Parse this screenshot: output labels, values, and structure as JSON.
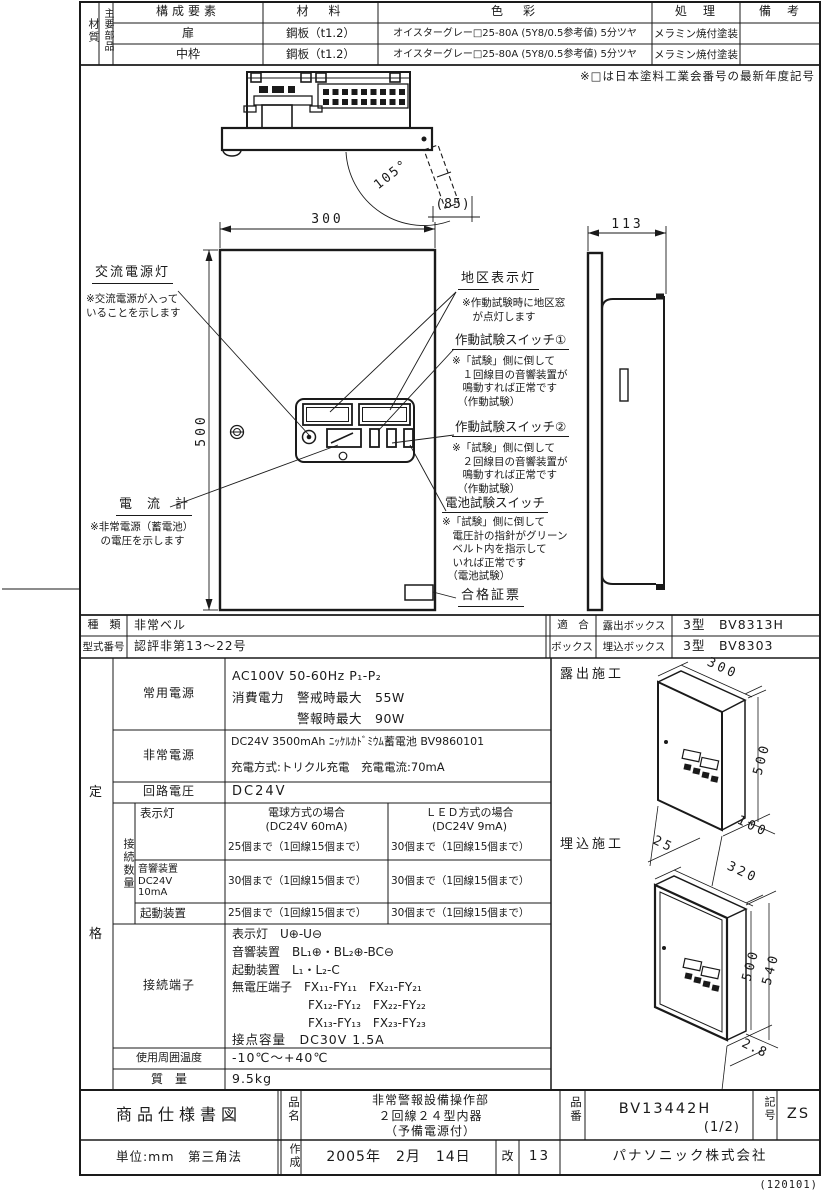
{
  "materials_table": {
    "corner": "材質",
    "row_group": "主要部品",
    "headers": {
      "component": "構成要素",
      "material": "材　料",
      "color": "色　彩",
      "process": "処　理",
      "remarks": "備　考"
    },
    "rows": [
      {
        "component": "扉",
        "material": "鋼板（t1.2）",
        "color": "オイスターグレー□25-80A (5Y8/0.5参考値) 5分ツヤ",
        "process": "メラミン焼付塗装",
        "remarks": ""
      },
      {
        "component": "中枠",
        "material": "鋼板（t1.2）",
        "color": "オイスターグレー□25-80A (5Y8/0.5参考値) 5分ツヤ",
        "process": "メラミン焼付塗装",
        "remarks": ""
      }
    ],
    "note": "※□は日本塗料工業会番号の最新年度記号"
  },
  "drawing": {
    "dimensions": {
      "front_width": "300",
      "front_height": "500",
      "side_depth": "113",
      "door_open_angle": "105°",
      "door_width": "(85)"
    },
    "callouts": {
      "ac_power_lamp": {
        "title": "交流電源灯",
        "note": "※交流電源が入って\nいることを示します"
      },
      "ammeter": {
        "title": "電　流　計",
        "note": "※非常電源（蓄電池）\n　の電圧を示します"
      },
      "zone_lamp": {
        "title": "地区表示灯",
        "note": "※作動試験時に地区窓\n　が点灯します"
      },
      "test_switch_1": {
        "title": "作動試験スイッチ①",
        "note": "※「試験」側に倒して\n　１回線目の音響装置が\n　鳴動すれば正常です\n　（作動試験）"
      },
      "test_switch_2": {
        "title": "作動試験スイッチ②",
        "note": "※「試験」側に倒して\n　２回線目の音響装置が\n　鳴動すれば正常です\n　（作動試験）"
      },
      "battery_test_switch": {
        "title": "電池試験スイッチ",
        "note": "※「試験」側に倒して\n　電圧計の指針がグリーン\n　ベルト内を指示して\n　いれば正常です\n　（電池試験）"
      },
      "approval_sticker": {
        "title": "合格証票"
      }
    }
  },
  "type_table": {
    "kind_label": "種　類",
    "kind": "非常ベル",
    "model_label": "型式番号",
    "model": "認評非第13～22号",
    "box_group_line1": "適　合",
    "box_group_line2": "ボックス",
    "boxes": [
      {
        "name": "露出ボックス",
        "value": "3型　BV8313H"
      },
      {
        "name": "埋込ボックス",
        "value": "3型　BV8303"
      }
    ]
  },
  "spec_table": {
    "group_label": "定格",
    "normal_power": {
      "label": "常用電源",
      "value": "AC100V 50-60Hz P₁-P₂\n消費電力　警戒時最大　55W\n　　　　　警報時最大　90W"
    },
    "emergency_power": {
      "label": "非常電源",
      "line1": "DC24V 3500mAh ﾆｯｹﾙｶﾄﾞﾐｳﾑ蓄電池 BV9860101",
      "line2": "充電方式:トリクル充電　充電電流:70mA"
    },
    "circuit_voltage": {
      "label": "回路電圧",
      "value": "DC24V"
    },
    "connection_counts": {
      "group_label": "接続数量",
      "col_bulb_header": "電球方式の場合\n(DC24V 60mA)",
      "col_led_header": "ＬＥＤ方式の場合\n(DC24V 9mA)",
      "rows": [
        {
          "label": "表示灯",
          "bulb": "25個まで（1回線15個まで）",
          "led": "30個まで（1回線15個まで）"
        },
        {
          "label": "音響装置\nDC24V\n10mA",
          "bulb": "30個まで（1回線15個まで）",
          "led": "30個まで（1回線15個まで）"
        },
        {
          "label": "起動装置",
          "bulb": "25個まで（1回線15個まで）",
          "led": "30個まで（1回線15個まで）"
        }
      ]
    },
    "terminals": {
      "label": "接続端子",
      "lines": [
        "表示灯　U⊕-U⊖",
        "音響装置　BL₁⊕・BL₂⊕-BC⊖",
        "起動装置　L₁・L₂-C",
        "無電圧端子　FX₁₁-FY₁₁　FX₂₁-FY₂₁",
        "FX₁₂-FY₁₂　FX₂₂-FY₂₂",
        "FX₁₃-FY₁₃　FX₂₃-FY₂₃",
        "接点容量　DC30V 1.5A"
      ]
    },
    "ambient_temp": {
      "label": "使用周囲温度",
      "value": "-10℃～+40℃"
    },
    "mass": {
      "label": "質　量",
      "value": "9.5kg"
    }
  },
  "installation": {
    "surface": {
      "label": "露出施工",
      "width": "300",
      "height": "500",
      "depth": "100",
      "offset": "25"
    },
    "flush": {
      "label": "埋込施工",
      "width": "320",
      "outer_height": "540",
      "inner_height": "500",
      "protrusion": "2.8"
    }
  },
  "title_block": {
    "doc_type": "商品仕様書図",
    "name_label": "品名",
    "product_name": "非常警報設備操作部\n２回線２４型内器\n（予備電源付）",
    "number_label": "品番",
    "product_number": "BV13442H",
    "product_number_page": "(1/2)",
    "symbol_label": "記号",
    "symbol": "ZS",
    "units": "単位:mm　第三角法",
    "created_label": "作成",
    "created_date": "2005年　2月　14日",
    "revision_label": "改",
    "revision": "13",
    "company": "パナソニック株式会社",
    "corner_code": "(120101)"
  }
}
